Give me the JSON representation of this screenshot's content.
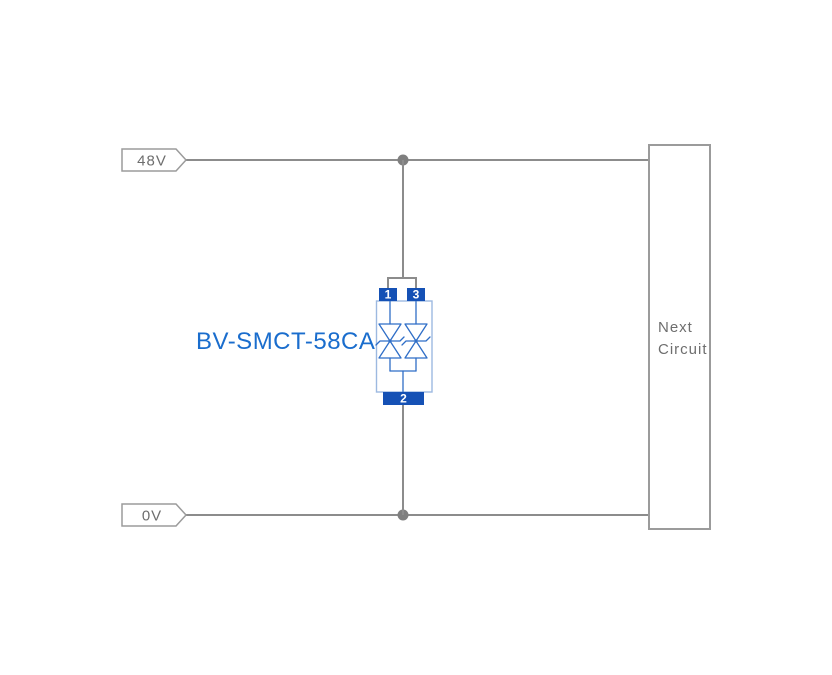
{
  "colors": {
    "background": "#ffffff",
    "wire_gray": "#8c8c8c",
    "junction_gray": "#7f7f7f",
    "outline_gray": "#9b9b9b",
    "text_gray": "#6e6e6e",
    "accent_blue": "#1a6dcd",
    "pin_blue": "#1551b5",
    "body_blue": "#9db9e0",
    "symbol_blue": "#2f6ec7"
  },
  "diagram": {
    "part_number": "BV-SMCT-58CA",
    "rails": {
      "top": {
        "label": "48V"
      },
      "bottom": {
        "label": "0V"
      }
    },
    "component": {
      "pins": {
        "pin1": "1",
        "pin2": "2",
        "pin3": "3"
      }
    },
    "next_circuit": {
      "line1": "Next",
      "line2": "Circuit"
    }
  }
}
